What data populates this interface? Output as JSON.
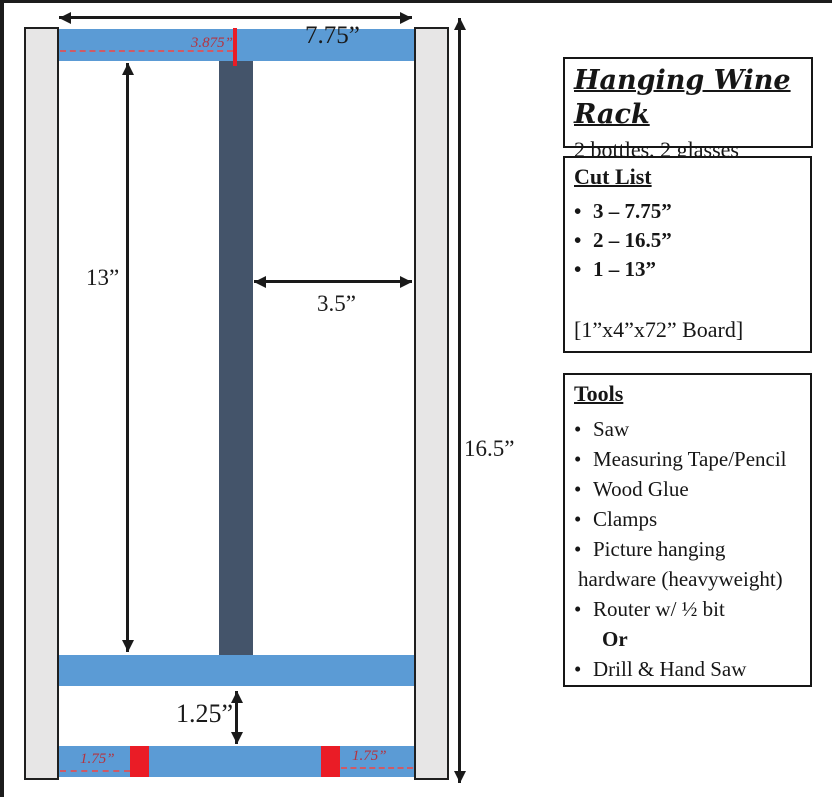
{
  "diagram": {
    "labels": {
      "total_width": "7.75”",
      "center_offset": "3.875”",
      "inner_height": "13”",
      "bay_width": "3.5”",
      "total_height": "16.5”",
      "bottom_gap": "1.25”",
      "notch_left": "1.75”",
      "notch_right": "1.75”"
    },
    "colors": {
      "board_blue": "#5b9bd5",
      "divider_navy": "#44546a",
      "rail_gray": "#e7e6e6",
      "accent_red": "#ea1c26",
      "red_text": "#b5333f"
    }
  },
  "panel": {
    "title_box": {
      "title": "Hanging Wine Rack",
      "subtitle": "2 bottles, 2 glasses"
    },
    "cut_list": {
      "heading": "Cut List",
      "items": [
        {
          "bullet": "•",
          "text": "3 – 7.75”"
        },
        {
          "bullet": "•",
          "text": "2 – 16.5”"
        },
        {
          "bullet": "•",
          "text": "1 – 13”"
        }
      ],
      "note": "[1”x4”x72” Board]"
    },
    "tools": {
      "heading": "Tools",
      "items": [
        {
          "bullet": "•",
          "text": "Saw"
        },
        {
          "bullet": "•",
          "text": "Measuring Tape/Pencil"
        },
        {
          "bullet": "•",
          "text": "Wood Glue"
        },
        {
          "bullet": "•",
          "text": "Clamps"
        },
        {
          "bullet": "•",
          "text": "Picture hanging"
        },
        {
          "bullet": "",
          "text": "hardware (heavyweight)"
        },
        {
          "bullet": "•",
          "text": "Router w/ ½ bit"
        },
        {
          "bullet": "",
          "text": "Or"
        },
        {
          "bullet": "•",
          "text": "Drill & Hand Saw"
        }
      ]
    }
  }
}
